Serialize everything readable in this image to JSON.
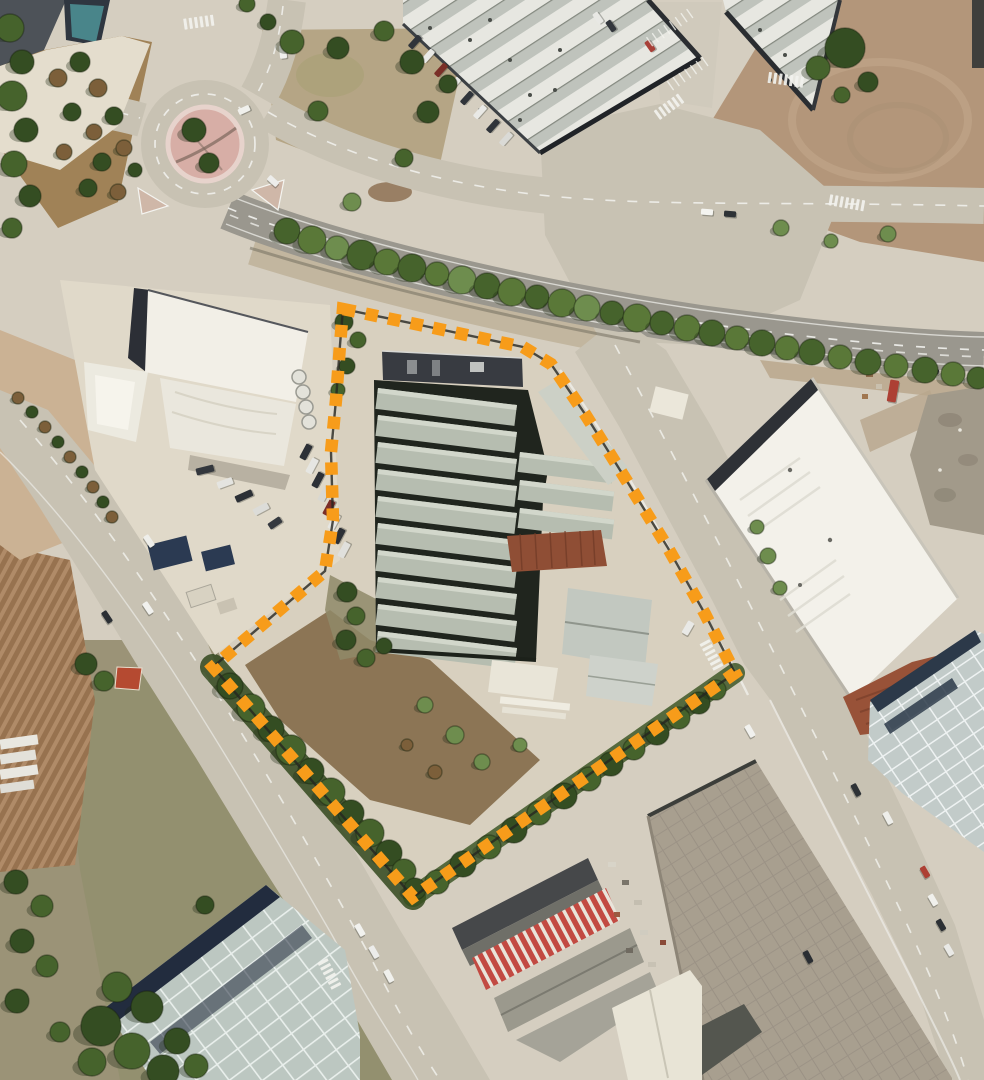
{
  "meta": {
    "kind": "aerial-satellite-view",
    "description": "Orthophoto of an industrial estate with an orange dashed parcel boundary annotation around a warehouse complex",
    "width": 984,
    "height": 1080,
    "visible_text": ""
  },
  "annotation": {
    "name": "parcel-boundary",
    "style": "dashed-squares-over-thin-dark-line",
    "color": "#F79C1A",
    "underlay_color": "#262621",
    "dash": [
      12.5,
      10.5
    ],
    "stroke_width": 12.5,
    "points": [
      [
        343,
        309
      ],
      [
        420,
        325
      ],
      [
        523,
        347
      ],
      [
        551,
        364
      ],
      [
        585,
        414
      ],
      [
        625,
        478
      ],
      [
        668,
        548
      ],
      [
        705,
        614
      ],
      [
        735,
        673
      ],
      [
        413,
        897
      ],
      [
        213,
        667
      ],
      [
        325,
        571
      ],
      [
        333,
        520
      ],
      [
        331,
        452
      ],
      [
        336,
        400
      ],
      [
        340,
        345
      ]
    ]
  },
  "palette": {
    "base": "#d5cec0",
    "concrete": "#ddd6c6",
    "road": "#c8c2b3",
    "asphalt": "#9a978e",
    "dirt": "#b3967a",
    "field": "#97724f",
    "furrow": "#b08b68",
    "scrub": "#9b9377",
    "shed_roof": "#b6bdb0",
    "shed_highlight": "#d2d7cb",
    "roof_gap": "#23281f",
    "navy_roof": "#2d323c",
    "white_roof": "#f3f1ea",
    "stripe_light": "#e7e7e1",
    "stripe_mid": "#bfc3bc",
    "rust_roof": "#8f4e35",
    "red_roof": "#c24a42",
    "teal_panel": "#bcc7c1",
    "blue_panel": "#c2cbc9",
    "taupe_roof": "#a89f8f",
    "island_pink": "#d7aea6",
    "teal_building": "#49858a",
    "tree_greens": [
      "#5a7838",
      "#46632c",
      "#6e8d4e",
      "#344d22",
      "#7c5f3a",
      "#8f8f6c"
    ],
    "marking_white": "#f2f2ee"
  },
  "scene": {
    "roundabout": {
      "cx": 205,
      "cy": 144,
      "outer_r": 64,
      "island_r": 37,
      "dash_r": 50
    },
    "roof_rows_main": {
      "x": 378,
      "w": 140,
      "h": 21,
      "tilt": 7,
      "ys": [
        388,
        415,
        442,
        469,
        496,
        523,
        550,
        577,
        604,
        631
      ]
    },
    "roof_rows_east": {
      "x": 520,
      "w": 95,
      "h": 20,
      "tilt": 7,
      "ys": [
        452,
        480,
        508
      ]
    }
  },
  "trees": [
    [
      287,
      231,
      13,
      2
    ],
    [
      312,
      240,
      14,
      1
    ],
    [
      337,
      248,
      12,
      3
    ],
    [
      362,
      255,
      15,
      2
    ],
    [
      387,
      262,
      13,
      1
    ],
    [
      412,
      268,
      14,
      2
    ],
    [
      437,
      274,
      12,
      1
    ],
    [
      462,
      280,
      14,
      3
    ],
    [
      487,
      286,
      13,
      2
    ],
    [
      512,
      292,
      14,
      1
    ],
    [
      537,
      297,
      12,
      2
    ],
    [
      562,
      303,
      14,
      1
    ],
    [
      587,
      308,
      13,
      3
    ],
    [
      612,
      313,
      12,
      2
    ],
    [
      637,
      318,
      14,
      1
    ],
    [
      662,
      323,
      12,
      2
    ],
    [
      687,
      328,
      13,
      1
    ],
    [
      712,
      333,
      13,
      2
    ],
    [
      737,
      338,
      12,
      1
    ],
    [
      762,
      343,
      13,
      2
    ],
    [
      787,
      348,
      12,
      1
    ],
    [
      812,
      352,
      13,
      2
    ],
    [
      840,
      357,
      12,
      1
    ],
    [
      868,
      362,
      13,
      2
    ],
    [
      896,
      366,
      12,
      1
    ],
    [
      925,
      370,
      13,
      2
    ],
    [
      953,
      374,
      12,
      1
    ],
    [
      978,
      378,
      11,
      2
    ],
    [
      352,
      202,
      9,
      3
    ],
    [
      10,
      28,
      14,
      2
    ],
    [
      22,
      62,
      12,
      4
    ],
    [
      12,
      96,
      15,
      2
    ],
    [
      26,
      130,
      12,
      4
    ],
    [
      14,
      164,
      13,
      2
    ],
    [
      30,
      196,
      11,
      4
    ],
    [
      12,
      228,
      10,
      2
    ],
    [
      58,
      78,
      9,
      5
    ],
    [
      80,
      62,
      10,
      4
    ],
    [
      98,
      88,
      9,
      5
    ],
    [
      72,
      112,
      9,
      4
    ],
    [
      94,
      132,
      8,
      5
    ],
    [
      114,
      116,
      9,
      4
    ],
    [
      64,
      152,
      8,
      5
    ],
    [
      102,
      162,
      9,
      4
    ],
    [
      124,
      148,
      8,
      5
    ],
    [
      88,
      188,
      9,
      4
    ],
    [
      118,
      192,
      8,
      5
    ],
    [
      135,
      170,
      7,
      4
    ],
    [
      292,
      42,
      12,
      2
    ],
    [
      338,
      48,
      11,
      4
    ],
    [
      384,
      31,
      10,
      2
    ],
    [
      412,
      62,
      12,
      4
    ],
    [
      318,
      111,
      10,
      2
    ],
    [
      428,
      112,
      11,
      4
    ],
    [
      404,
      158,
      9,
      2
    ],
    [
      448,
      84,
      9,
      4
    ],
    [
      194,
      130,
      12,
      4
    ],
    [
      209,
      163,
      10,
      4
    ],
    [
      247,
      4,
      8,
      2
    ],
    [
      268,
      22,
      8,
      4
    ],
    [
      845,
      48,
      20,
      4
    ],
    [
      818,
      68,
      12,
      2
    ],
    [
      868,
      82,
      10,
      4
    ],
    [
      842,
      95,
      8,
      2
    ],
    [
      781,
      228,
      8,
      3
    ],
    [
      831,
      241,
      7,
      3
    ],
    [
      888,
      234,
      8,
      3
    ],
    [
      344,
      322,
      9,
      4
    ],
    [
      358,
      340,
      8,
      2
    ],
    [
      347,
      366,
      8,
      4
    ],
    [
      338,
      390,
      7,
      2
    ],
    [
      347,
      592,
      10,
      4
    ],
    [
      356,
      616,
      9,
      2
    ],
    [
      346,
      640,
      10,
      4
    ],
    [
      366,
      658,
      9,
      2
    ],
    [
      384,
      646,
      8,
      4
    ],
    [
      230,
      686,
      13,
      4
    ],
    [
      251,
      708,
      14,
      2
    ],
    [
      271,
      729,
      13,
      4
    ],
    [
      291,
      750,
      15,
      2
    ],
    [
      311,
      771,
      13,
      4
    ],
    [
      331,
      792,
      14,
      2
    ],
    [
      351,
      813,
      13,
      4
    ],
    [
      370,
      833,
      14,
      2
    ],
    [
      389,
      853,
      13,
      4
    ],
    [
      404,
      871,
      12,
      2
    ],
    [
      415,
      889,
      11,
      4
    ],
    [
      437,
      882,
      12,
      2
    ],
    [
      463,
      864,
      13,
      4
    ],
    [
      489,
      847,
      12,
      2
    ],
    [
      514,
      830,
      13,
      4
    ],
    [
      539,
      813,
      12,
      2
    ],
    [
      564,
      796,
      13,
      4
    ],
    [
      589,
      779,
      12,
      2
    ],
    [
      611,
      764,
      12,
      4
    ],
    [
      634,
      749,
      11,
      2
    ],
    [
      657,
      733,
      12,
      4
    ],
    [
      679,
      718,
      11,
      2
    ],
    [
      699,
      703,
      11,
      4
    ],
    [
      716,
      690,
      10,
      2
    ],
    [
      425,
      705,
      8,
      3
    ],
    [
      455,
      735,
      9,
      3
    ],
    [
      482,
      762,
      8,
      3
    ],
    [
      435,
      772,
      7,
      5
    ],
    [
      407,
      745,
      6,
      5
    ],
    [
      520,
      745,
      7,
      3
    ],
    [
      101,
      1026,
      20,
      4
    ],
    [
      132,
      1051,
      18,
      2
    ],
    [
      163,
      1071,
      16,
      4
    ],
    [
      117,
      987,
      15,
      2
    ],
    [
      147,
      1007,
      16,
      4
    ],
    [
      92,
      1062,
      14,
      2
    ],
    [
      177,
      1041,
      13,
      4
    ],
    [
      196,
      1066,
      12,
      2
    ],
    [
      16,
      882,
      12,
      4
    ],
    [
      42,
      906,
      11,
      2
    ],
    [
      22,
      941,
      12,
      4
    ],
    [
      47,
      966,
      11,
      2
    ],
    [
      17,
      1001,
      12,
      4
    ],
    [
      60,
      1032,
      10,
      2
    ],
    [
      86,
      664,
      11,
      4
    ],
    [
      104,
      681,
      10,
      2
    ],
    [
      205,
      905,
      9,
      4
    ],
    [
      768,
      556,
      8,
      3
    ],
    [
      780,
      588,
      7,
      3
    ],
    [
      757,
      527,
      7,
      3
    ],
    [
      18,
      398,
      6,
      5
    ],
    [
      32,
      412,
      6,
      4
    ],
    [
      45,
      427,
      6,
      5
    ],
    [
      58,
      442,
      6,
      4
    ],
    [
      70,
      457,
      6,
      5
    ],
    [
      82,
      472,
      6,
      4
    ],
    [
      93,
      487,
      6,
      5
    ],
    [
      103,
      502,
      6,
      4
    ],
    [
      112,
      517,
      6,
      5
    ]
  ],
  "vehicles": [
    [
      296,
      231,
      13,
      6,
      16,
      "#f2f1ed"
    ],
    [
      322,
      240,
      13,
      6,
      15,
      "#e9e9e5"
    ],
    [
      244,
      110,
      12,
      6,
      -25,
      "#f0f0ec"
    ],
    [
      273,
      181,
      12,
      6,
      42,
      "#ededeb"
    ],
    [
      283,
      52,
      7,
      13,
      -6,
      "#f0f0ed"
    ],
    [
      707,
      212,
      12,
      6,
      4,
      "#f4f4f0"
    ],
    [
      730,
      214,
      12,
      6,
      4,
      "#2e3236"
    ],
    [
      598,
      18,
      6,
      12,
      -35,
      "#e8e8e4"
    ],
    [
      611,
      26,
      6,
      12,
      -35,
      "#32363c"
    ],
    [
      650,
      46,
      6,
      12,
      -35,
      "#a84038"
    ],
    [
      415,
      42,
      15,
      6,
      -48,
      "#30343a"
    ],
    [
      428,
      56,
      15,
      6,
      -48,
      "#e9e9e6"
    ],
    [
      441,
      70,
      15,
      6,
      -48,
      "#7a2f28"
    ],
    [
      454,
      84,
      15,
      6,
      -48,
      "#e9e9e6"
    ],
    [
      467,
      98,
      15,
      6,
      -48,
      "#30343a"
    ],
    [
      480,
      112,
      15,
      6,
      -48,
      "#e9e9e6"
    ],
    [
      493,
      126,
      15,
      6,
      -48,
      "#30343a"
    ],
    [
      506,
      139,
      15,
      6,
      -48,
      "#dadad6"
    ],
    [
      306,
      452,
      16,
      7,
      -62,
      "#2c3036"
    ],
    [
      312,
      466,
      16,
      7,
      -62,
      "#e6e6e2"
    ],
    [
      318,
      480,
      16,
      7,
      -62,
      "#2c3036"
    ],
    [
      324,
      494,
      16,
      7,
      -62,
      "#d8d8d2"
    ],
    [
      329,
      508,
      16,
      7,
      -62,
      "#7a2e28"
    ],
    [
      334,
      522,
      16,
      7,
      -62,
      "#e6e6e2"
    ],
    [
      339,
      536,
      16,
      7,
      -62,
      "#2c3036"
    ],
    [
      344,
      550,
      16,
      7,
      -62,
      "#e0e0dc"
    ],
    [
      205,
      470,
      18,
      7,
      -14,
      "#33373d"
    ],
    [
      225,
      483,
      16,
      7,
      -20,
      "#e4e4e0"
    ],
    [
      244,
      496,
      18,
      7,
      -24,
      "#2c3036"
    ],
    [
      261,
      509,
      16,
      7,
      -28,
      "#dcdcd8"
    ],
    [
      275,
      523,
      14,
      7,
      -34,
      "#35393f"
    ],
    [
      107,
      617,
      13,
      6,
      56,
      "#2b2f34"
    ],
    [
      148,
      608,
      13,
      6,
      56,
      "#f1f1ee"
    ],
    [
      149,
      541,
      13,
      6,
      56,
      "#eeeeea"
    ],
    [
      360,
      930,
      13,
      6,
      60,
      "#f2f2ef"
    ],
    [
      374,
      952,
      13,
      6,
      60,
      "#ececea"
    ],
    [
      389,
      976,
      13,
      6,
      62,
      "#f0f0ec"
    ],
    [
      750,
      731,
      13,
      6,
      60,
      "#f1f1ee"
    ],
    [
      856,
      790,
      13,
      6,
      62,
      "#2e3236"
    ],
    [
      888,
      818,
      13,
      6,
      62,
      "#eeeeea"
    ],
    [
      808,
      957,
      13,
      6,
      62,
      "#2a2e33"
    ],
    [
      925,
      872,
      12,
      6,
      60,
      "#ad4034"
    ],
    [
      933,
      900,
      12,
      6,
      60,
      "#f0f0ec"
    ],
    [
      941,
      925,
      12,
      6,
      60,
      "#2c3034"
    ],
    [
      949,
      950,
      12,
      6,
      60,
      "#e9e9e6"
    ],
    [
      893,
      391,
      9,
      22,
      10,
      "#ad4034"
    ],
    [
      921,
      367,
      10,
      5,
      14,
      "#e8e8e4"
    ],
    [
      934,
      371,
      10,
      5,
      14,
      "#2e3236"
    ],
    [
      947,
      375,
      10,
      5,
      14,
      "#b5453c"
    ],
    [
      959,
      379,
      10,
      5,
      14,
      "#e4e4e0"
    ],
    [
      688,
      628,
      7,
      14,
      30,
      "#e9e9e6"
    ]
  ],
  "crosswalks": [
    [
      200,
      22,
      -8,
      6
    ],
    [
      670,
      106,
      -36,
      6
    ],
    [
      848,
      203,
      10,
      7
    ],
    [
      712,
      656,
      62,
      6
    ],
    [
      330,
      975,
      62,
      6
    ],
    [
      787,
      80,
      8,
      7
    ]
  ],
  "parking_bays": [
    [
      672,
      26,
      -35,
      8
    ],
    [
      690,
      72,
      -35,
      7
    ]
  ]
}
